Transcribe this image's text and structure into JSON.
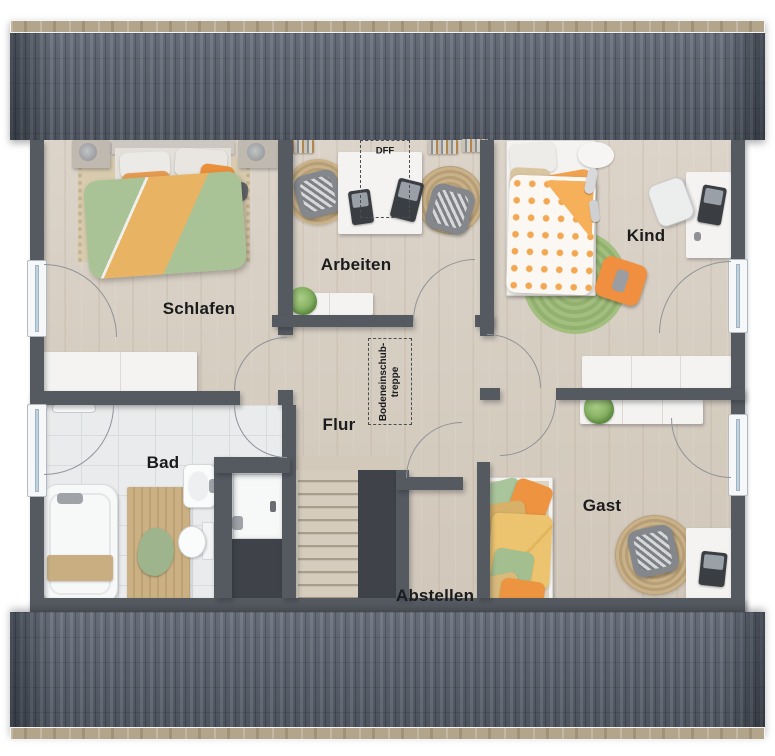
{
  "floorplan": {
    "rooms": [
      {
        "id": "schlafen",
        "label": "Schlafen"
      },
      {
        "id": "arbeiten",
        "label": "Arbeiten"
      },
      {
        "id": "kind",
        "label": "Kind"
      },
      {
        "id": "flur",
        "label": "Flur"
      },
      {
        "id": "bad",
        "label": "Bad"
      },
      {
        "id": "abstellen",
        "label": "Abstellen"
      },
      {
        "id": "gast",
        "label": "Gast"
      }
    ],
    "annotations": {
      "roof_window": {
        "label": "DFF"
      },
      "attic_ladder": {
        "line1": "Bodeneinschub-",
        "line2": "treppe"
      }
    },
    "colors": {
      "roof": "#5b6370",
      "ridge_board": "#b3a58b",
      "wall": "#555a61",
      "wood_floor": "#d8cfc3",
      "tile_floor": "#e9ebec",
      "void": "#3f4349",
      "furniture_white": "#f4f3f1",
      "duvet_green": "#a9c396",
      "duvet_orange": "#e8b464",
      "kid_orange": "#f2a24e",
      "rug_jute": "#c4ae87",
      "rug_green": "#9cba7b",
      "blanket_yellow": "#ecc470"
    }
  }
}
